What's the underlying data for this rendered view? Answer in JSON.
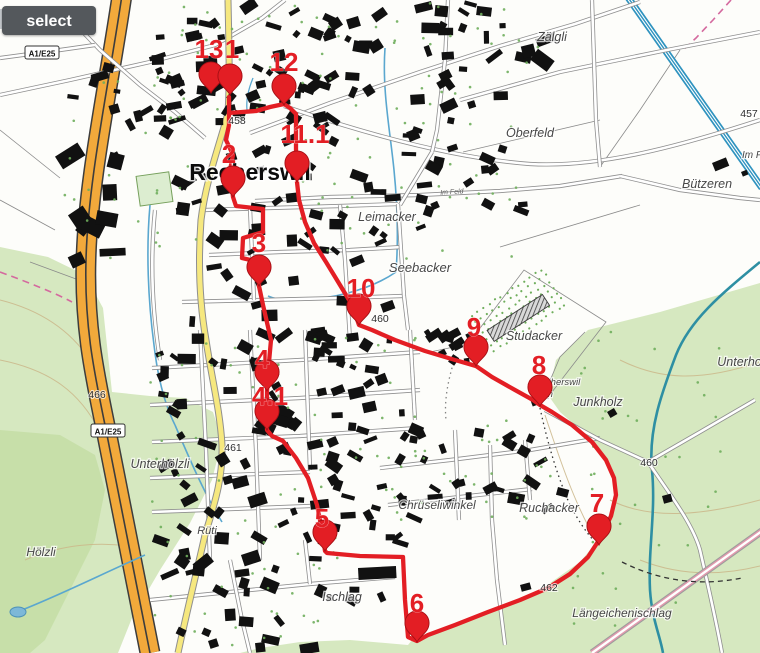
{
  "toolbar": {
    "select_label": "select"
  },
  "map": {
    "colors": {
      "route": "#e31e24",
      "marker": "#e31e24",
      "marker_edge": "#a50f14",
      "forest": "#d6e8c0",
      "forest_dark": "#c7dfa9",
      "motorway": "#f2a93b",
      "main_road": "#f6e87f",
      "water": "#5aa7cf",
      "river": "#2e8fa3"
    },
    "town_labels": [
      {
        "text": "Recherswil",
        "x": 250,
        "y": 180,
        "size": 23
      }
    ],
    "field_labels": [
      {
        "text": "Pfaffenacker",
        "x": 38,
        "y": 33,
        "size": 12
      },
      {
        "text": "Zälgli",
        "x": 552,
        "y": 41,
        "size": 12.5
      },
      {
        "text": "Oberfeld",
        "x": 530,
        "y": 137,
        "size": 12.5
      },
      {
        "text": "Bützeren",
        "x": 707,
        "y": 188,
        "size": 12.5
      },
      {
        "text": "Leimacker",
        "x": 387,
        "y": 221,
        "size": 12.5
      },
      {
        "text": "Seebacker",
        "x": 420,
        "y": 272,
        "size": 13
      },
      {
        "text": "Studacker",
        "x": 534,
        "y": 340,
        "size": 12.5
      },
      {
        "text": "Unterholz",
        "x": 744,
        "y": 366,
        "size": 12.5
      },
      {
        "text": "Junkholz",
        "x": 598,
        "y": 406,
        "size": 12.5
      },
      {
        "text": "Ruchacker",
        "x": 549,
        "y": 512,
        "size": 12.5
      },
      {
        "text": "Längeichenischlag",
        "x": 622,
        "y": 617,
        "size": 12
      },
      {
        "text": "Ischlag",
        "x": 342,
        "y": 601,
        "size": 12.5
      },
      {
        "text": "Chrüseliwinkel",
        "x": 437,
        "y": 509,
        "size": 12
      },
      {
        "text": "Unterhölzli",
        "x": 160,
        "y": 468,
        "size": 12.5
      },
      {
        "text": "Hölzli",
        "x": 41,
        "y": 556,
        "size": 12
      },
      {
        "text": "Rüti",
        "x": 207,
        "y": 534,
        "size": 11
      },
      {
        "text": "Recherswil",
        "x": 557,
        "y": 385,
        "size": 9.5
      },
      {
        "text": "m",
        "x": 549,
        "y": 397,
        "size": 9.5
      },
      {
        "text": "Im F",
        "x": 752,
        "y": 158,
        "size": 10
      }
    ],
    "street_labels": [
      {
        "text": "Im Feld",
        "x": 452,
        "y": 194,
        "rot": -4
      }
    ],
    "elevations": [
      {
        "text": "457",
        "x": 749,
        "y": 117
      },
      {
        "text": "458",
        "x": 237,
        "y": 124
      },
      {
        "text": "460",
        "x": 380,
        "y": 322
      },
      {
        "text": "460",
        "x": 649,
        "y": 466
      },
      {
        "text": "461",
        "x": 233,
        "y": 451
      },
      {
        "text": "462",
        "x": 549,
        "y": 591
      },
      {
        "text": "466",
        "x": 97,
        "y": 398
      }
    ],
    "road_badges": [
      {
        "text": "A1/E25",
        "x": 42,
        "y": 53
      },
      {
        "text": "A1/E25",
        "x": 108,
        "y": 431
      }
    ],
    "markers": [
      {
        "label": "13",
        "lx": 209,
        "ly": 58,
        "px": 211,
        "py": 93
      },
      {
        "label": "1",
        "lx": 232,
        "ly": 58,
        "px": 230,
        "py": 95
      },
      {
        "label": "12",
        "lx": 284,
        "ly": 71,
        "px": 284,
        "py": 105
      },
      {
        "label": "11.1",
        "lx": 305,
        "ly": 143,
        "px": 297,
        "py": 182
      },
      {
        "label": "2",
        "lx": 229,
        "ly": 163,
        "px": 233,
        "py": 197
      },
      {
        "label": "3",
        "lx": 259,
        "ly": 252,
        "px": 259,
        "py": 286
      },
      {
        "label": "10",
        "lx": 361,
        "ly": 297,
        "px": 359,
        "py": 325
      },
      {
        "label": "9",
        "lx": 474,
        "ly": 336,
        "px": 476,
        "py": 366
      },
      {
        "label": "8",
        "lx": 539,
        "ly": 374,
        "px": 540,
        "py": 406
      },
      {
        "label": "4",
        "lx": 262,
        "ly": 368,
        "px": 267,
        "py": 391
      },
      {
        "label": "4.1",
        "lx": 270,
        "ly": 405,
        "px": 267,
        "py": 430
      },
      {
        "label": "7",
        "lx": 597,
        "ly": 512,
        "px": 599,
        "py": 545
      },
      {
        "label": "5",
        "lx": 322,
        "ly": 527,
        "px": 325,
        "py": 551
      },
      {
        "label": "6",
        "lx": 417,
        "ly": 612,
        "px": 417,
        "py": 642
      }
    ]
  }
}
